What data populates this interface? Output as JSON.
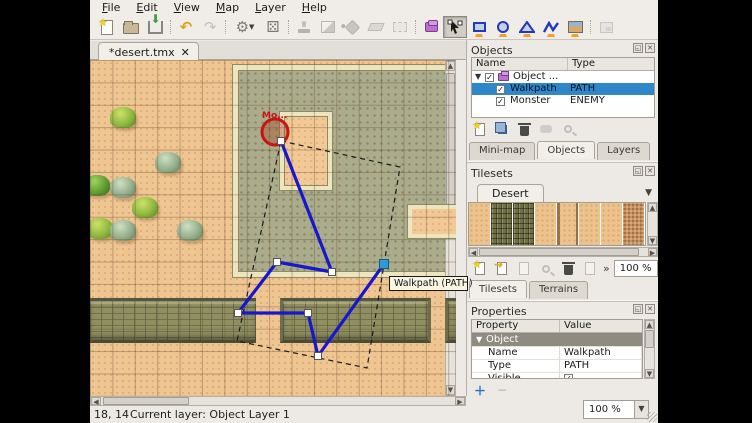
{
  "menu": {
    "items": [
      "File",
      "Edit",
      "View",
      "Map",
      "Layer",
      "Help"
    ]
  },
  "toolbar": {
    "tools": [
      "New",
      "Open",
      "Save",
      "Undo",
      "Redo",
      "Commands",
      "Random Mode",
      "Stamp Brush",
      "Terrain Brush",
      "Bucket Fill Tool",
      "Eraser",
      "Rectangular Select",
      "New Object Layer",
      "Select Objects",
      "Insert Rectangle",
      "Insert Ellipse",
      "Insert Polygon",
      "Insert Polyline",
      "Insert Tile",
      "Highlight Current Layer"
    ]
  },
  "document_tab": {
    "label": "*desert.tmx",
    "close_glyph": "✕"
  },
  "map": {
    "monster_label": "Mo...",
    "tooltip": "Walkpath (PATH)",
    "walkpath_points": [
      [
        191,
        81
      ],
      [
        242,
        212
      ],
      [
        187,
        202
      ],
      [
        148,
        253
      ],
      [
        218,
        253
      ],
      [
        228,
        296
      ],
      [
        294,
        204
      ]
    ],
    "selected_point_index": 6,
    "selection_polygon": [
      [
        191,
        81
      ],
      [
        310,
        107
      ],
      [
        277,
        308
      ],
      [
        147,
        281
      ]
    ],
    "monster_circle": {
      "cx": 185,
      "cy": 72,
      "rx": 13,
      "ry": 13
    },
    "bushes": [
      {
        "x": 33,
        "y": 57,
        "tone": "bright"
      },
      {
        "x": 78,
        "y": 102,
        "tone": "sage"
      },
      {
        "x": 7,
        "y": 125,
        "tone": "deep"
      },
      {
        "x": 33,
        "y": 127,
        "tone": "sage"
      },
      {
        "x": 55,
        "y": 147,
        "tone": "bright"
      },
      {
        "x": 10,
        "y": 168,
        "tone": "bright"
      },
      {
        "x": 33,
        "y": 170,
        "tone": "sage"
      },
      {
        "x": 100,
        "y": 170,
        "tone": "sage"
      }
    ],
    "colors": {
      "walkpath": "#1717cf",
      "selection_dash": "#1a1a1a",
      "monster_stroke": "#c81414",
      "selected_handle": "#2f9ad8",
      "sand": "#efc592",
      "ruin_floor": "#abac8c"
    }
  },
  "objects_panel": {
    "title": "Objects",
    "columns": {
      "name": "Name",
      "type": "Type"
    },
    "rows": [
      {
        "name": "Object ...",
        "type": "",
        "checked": "✓"
      },
      {
        "name": "Walkpath",
        "type": "PATH",
        "checked": "✓"
      },
      {
        "name": "Monster",
        "type": "ENEMY",
        "checked": "✓"
      }
    ]
  },
  "dock_tabs_top": {
    "minimap": "Mini-map",
    "objects": "Objects",
    "layers": "Layers"
  },
  "tilesets_panel": {
    "title": "Tilesets",
    "tileset_tab": "Desert",
    "zoom_value": "100 %",
    "overflow_glyph": "»"
  },
  "dock_tabs_mid": {
    "tilesets": "Tilesets",
    "terrains": "Terrains"
  },
  "properties_panel": {
    "title": "Properties",
    "columns": {
      "property": "Property",
      "value": "Value"
    },
    "group": "Object",
    "rows": [
      {
        "property": "Name",
        "value": "Walkpath"
      },
      {
        "property": "Type",
        "value": "PATH"
      },
      {
        "property": "Visible",
        "value": "✓"
      }
    ],
    "add_label": "＋",
    "remove_label": "−"
  },
  "statusbar": {
    "coords": "18, 14",
    "current_layer": "Current layer: Object Layer 1",
    "zoom_value": "100 %"
  }
}
